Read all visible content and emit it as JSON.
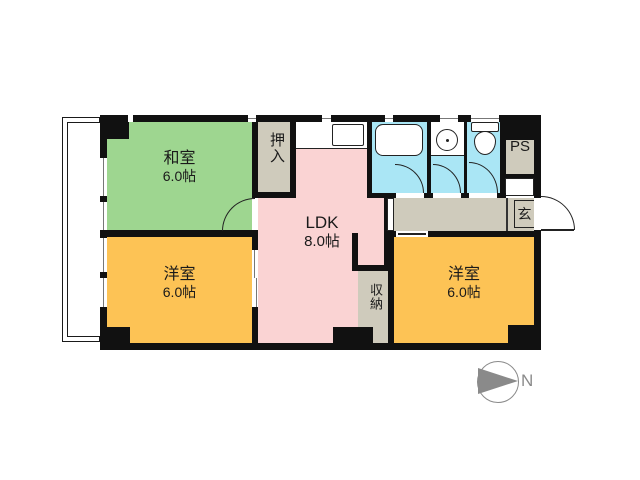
{
  "title": "2LDK apartment floor plan",
  "rooms": {
    "washitsu": {
      "name": "和室",
      "size": "6.0帖",
      "color": "#9ed690"
    },
    "ldk": {
      "name": "LDK",
      "size": "8.0帖",
      "color": "#fad3d3"
    },
    "western_left": {
      "name": "洋室",
      "size": "6.0帖",
      "color": "#fdc355"
    },
    "western_right": {
      "name": "洋室",
      "size": "6.0帖",
      "color": "#fdc355"
    },
    "oshiire": {
      "name": "押入",
      "color": "#cfcbbc"
    },
    "storage": {
      "name": "収納",
      "color": "#cfcbbc"
    },
    "entrance": {
      "name": "玄",
      "color": "#cfcbbc"
    },
    "pipe_space": {
      "name": "PS",
      "color": "#cfcbbc"
    },
    "wet_area_color": "#aae6f5",
    "wall_color": "#111111"
  },
  "icons": {
    "bathtub": "rounded-rect",
    "washbasin": "circle-with-dot",
    "toilet": "tank-and-bowl",
    "kitchen_sink": "rect",
    "door_arc": "quarter-circle",
    "north_arrow": "right-pointing-triangle"
  },
  "compass": {
    "label": "N",
    "color": "#8a8a8a"
  }
}
